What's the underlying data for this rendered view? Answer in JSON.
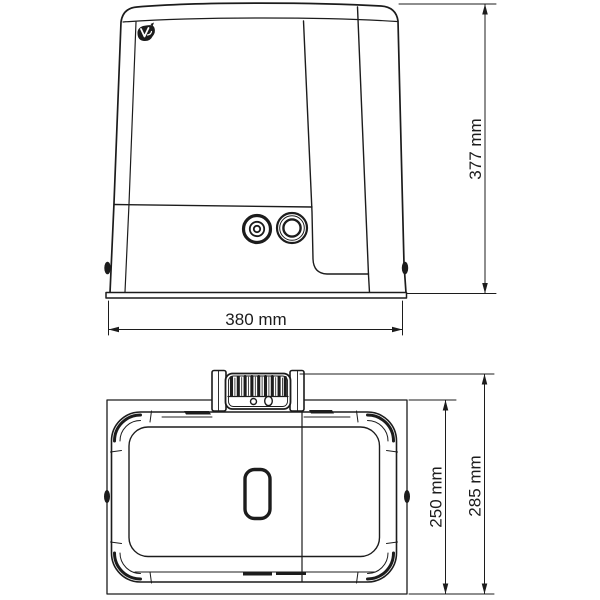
{
  "diagram": {
    "background": "#ffffff",
    "ink": "#1c1c1c",
    "front_view": {
      "width_label": "380 mm",
      "height_label": "377 mm"
    },
    "top_view": {
      "body_depth_label": "250 mm",
      "overall_depth_label": "285 mm"
    },
    "dimensions_mm": {
      "width": 380,
      "height": 377,
      "body_depth": 250,
      "overall_depth": 285
    },
    "icons": {
      "brand_emblem": "v2-logo-icon"
    }
  }
}
